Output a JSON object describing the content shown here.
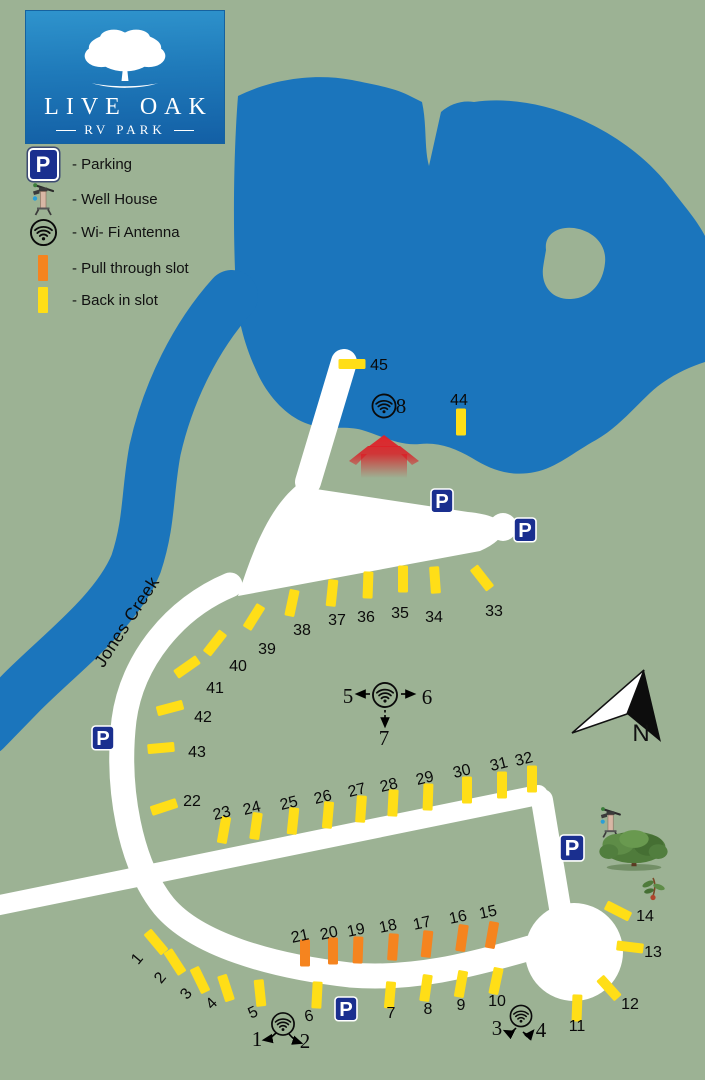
{
  "logo": {
    "title": "LIVE OAK",
    "subtitle": "RV PARK"
  },
  "legend": {
    "items": [
      {
        "icon": "parking-sign",
        "label": "- Parking"
      },
      {
        "icon": "well-house",
        "label": "- Well House"
      },
      {
        "icon": "wifi-antenna",
        "label": "- Wi- Fi Antenna"
      },
      {
        "icon": "pull-through-slot",
        "label": "- Pull through slot"
      },
      {
        "icon": "back-in-slot",
        "label": "- Back in slot"
      }
    ]
  },
  "map": {
    "creek_label": "Jones Creek",
    "north_label": "N",
    "parking_letter": "P",
    "colors": {
      "water": "#1B75BC",
      "ground": "#9CB294",
      "road": "#FFFFFF",
      "back_in": "#FFDE17",
      "pull_through": "#F5841F",
      "parking": "#1A2F8F",
      "building": "#E01F26"
    },
    "parking_signs": [
      {
        "x": 431,
        "y": 489,
        "s": 22
      },
      {
        "x": 514,
        "y": 518,
        "s": 22
      },
      {
        "x": 92,
        "y": 726,
        "s": 22
      },
      {
        "x": 560,
        "y": 835,
        "s": 24
      },
      {
        "x": 335,
        "y": 997,
        "s": 22
      }
    ],
    "slots": [
      {
        "n": 1,
        "cx": 156,
        "cy": 942,
        "rot": -40,
        "lx": 141,
        "ly": 962,
        "lrot": -50,
        "type": "back"
      },
      {
        "n": 2,
        "cx": 175,
        "cy": 962,
        "rot": -33,
        "lx": 164,
        "ly": 981,
        "lrot": -50,
        "type": "back"
      },
      {
        "n": 3,
        "cx": 200,
        "cy": 980,
        "rot": -26,
        "lx": 190,
        "ly": 997,
        "lrot": -50,
        "type": "back"
      },
      {
        "n": 4,
        "cx": 226,
        "cy": 988,
        "rot": -18,
        "lx": 215,
        "ly": 1007,
        "lrot": -45,
        "type": "back"
      },
      {
        "n": 5,
        "cx": 260,
        "cy": 993,
        "rot": -6,
        "lx": 255,
        "ly": 1017,
        "lrot": -25,
        "type": "back"
      },
      {
        "n": 6,
        "cx": 317,
        "cy": 995,
        "rot": 3,
        "lx": 310,
        "ly": 1021,
        "lrot": -12,
        "type": "back"
      },
      {
        "n": 7,
        "cx": 390,
        "cy": 995,
        "rot": 5,
        "lx": 391,
        "ly": 1018,
        "lrot": 0,
        "type": "back"
      },
      {
        "n": 8,
        "cx": 426,
        "cy": 988,
        "rot": 8,
        "lx": 428,
        "ly": 1014,
        "lrot": 0,
        "type": "back"
      },
      {
        "n": 9,
        "cx": 461,
        "cy": 984,
        "rot": 10,
        "lx": 461,
        "ly": 1010,
        "lrot": 0,
        "type": "back"
      },
      {
        "n": 10,
        "cx": 496,
        "cy": 981,
        "rot": 12,
        "lx": 497,
        "ly": 1006,
        "lrot": 0,
        "type": "back"
      },
      {
        "n": 11,
        "cx": 577,
        "cy": 1008,
        "rot": 2,
        "lx": 577,
        "ly": 1031,
        "lrot": 0,
        "type": "back"
      },
      {
        "n": 12,
        "cx": 609,
        "cy": 988,
        "rot": -42,
        "lx": 630,
        "ly": 1009,
        "lrot": 0,
        "type": "back"
      },
      {
        "n": 13,
        "cx": 630,
        "cy": 947,
        "rot": -83,
        "lx": 653,
        "ly": 957,
        "lrot": 0,
        "type": "back"
      },
      {
        "n": 14,
        "cx": 618,
        "cy": 911,
        "rot": -63,
        "lx": 645,
        "ly": 921,
        "lrot": 0,
        "type": "back"
      },
      {
        "n": 15,
        "cx": 492,
        "cy": 935,
        "rot": 10,
        "lx": 489,
        "ly": 917,
        "lrot": -12,
        "type": "pull"
      },
      {
        "n": 16,
        "cx": 462,
        "cy": 938,
        "rot": 8,
        "lx": 459,
        "ly": 922,
        "lrot": -12,
        "type": "pull"
      },
      {
        "n": 17,
        "cx": 427,
        "cy": 944,
        "rot": 6,
        "lx": 423,
        "ly": 928,
        "lrot": -12,
        "type": "pull"
      },
      {
        "n": 18,
        "cx": 393,
        "cy": 947,
        "rot": 4,
        "lx": 389,
        "ly": 931,
        "lrot": -12,
        "type": "pull"
      },
      {
        "n": 19,
        "cx": 358,
        "cy": 950,
        "rot": 2,
        "lx": 357,
        "ly": 935,
        "lrot": -12,
        "type": "pull"
      },
      {
        "n": 20,
        "cx": 333,
        "cy": 951,
        "rot": 0,
        "lx": 330,
        "ly": 938,
        "lrot": -12,
        "type": "pull"
      },
      {
        "n": 21,
        "cx": 305,
        "cy": 953,
        "rot": 0,
        "lx": 301,
        "ly": 941,
        "lrot": -12,
        "type": "pull"
      },
      {
        "n": 22,
        "cx": 164,
        "cy": 807,
        "rot": 72,
        "lx": 192,
        "ly": 806,
        "lrot": 0,
        "type": "back"
      },
      {
        "n": 23,
        "cx": 224,
        "cy": 830,
        "rot": 10,
        "lx": 223,
        "ly": 818,
        "lrot": -14,
        "type": "back"
      },
      {
        "n": 24,
        "cx": 256,
        "cy": 826,
        "rot": 8,
        "lx": 253,
        "ly": 813,
        "lrot": -14,
        "type": "back"
      },
      {
        "n": 25,
        "cx": 293,
        "cy": 821,
        "rot": 6,
        "lx": 290,
        "ly": 808,
        "lrot": -14,
        "type": "back"
      },
      {
        "n": 26,
        "cx": 328,
        "cy": 815,
        "rot": 5,
        "lx": 324,
        "ly": 802,
        "lrot": -14,
        "type": "back"
      },
      {
        "n": 27,
        "cx": 361,
        "cy": 809,
        "rot": 4,
        "lx": 358,
        "ly": 795,
        "lrot": -14,
        "type": "back"
      },
      {
        "n": 28,
        "cx": 393,
        "cy": 803,
        "rot": 3,
        "lx": 390,
        "ly": 790,
        "lrot": -14,
        "type": "back"
      },
      {
        "n": 29,
        "cx": 428,
        "cy": 797,
        "rot": 2,
        "lx": 426,
        "ly": 783,
        "lrot": -14,
        "type": "back"
      },
      {
        "n": 30,
        "cx": 467,
        "cy": 790,
        "rot": 0,
        "lx": 463,
        "ly": 776,
        "lrot": -14,
        "type": "back"
      },
      {
        "n": 31,
        "cx": 502,
        "cy": 785,
        "rot": 0,
        "lx": 500,
        "ly": 769,
        "lrot": -14,
        "type": "back"
      },
      {
        "n": 32,
        "cx": 532,
        "cy": 779,
        "rot": 0,
        "lx": 525,
        "ly": 764,
        "lrot": -14,
        "type": "back"
      },
      {
        "n": 33,
        "cx": 482,
        "cy": 578,
        "rot": -38,
        "lx": 494,
        "ly": 616,
        "lrot": 0,
        "type": "back"
      },
      {
        "n": 34,
        "cx": 435,
        "cy": 580,
        "rot": -4,
        "lx": 434,
        "ly": 622,
        "lrot": 0,
        "type": "back"
      },
      {
        "n": 35,
        "cx": 403,
        "cy": 579,
        "rot": 0,
        "lx": 400,
        "ly": 618,
        "lrot": 0,
        "type": "back"
      },
      {
        "n": 36,
        "cx": 368,
        "cy": 585,
        "rot": 2,
        "lx": 366,
        "ly": 622,
        "lrot": 0,
        "type": "back"
      },
      {
        "n": 37,
        "cx": 332,
        "cy": 593,
        "rot": 6,
        "lx": 337,
        "ly": 625,
        "lrot": 0,
        "type": "back"
      },
      {
        "n": 38,
        "cx": 292,
        "cy": 603,
        "rot": 12,
        "lx": 302,
        "ly": 635,
        "lrot": 0,
        "type": "back"
      },
      {
        "n": 39,
        "cx": 254,
        "cy": 617,
        "rot": 32,
        "lx": 267,
        "ly": 654,
        "lrot": 0,
        "type": "back"
      },
      {
        "n": 40,
        "cx": 215,
        "cy": 643,
        "rot": 38,
        "lx": 238,
        "ly": 671,
        "lrot": 0,
        "type": "back"
      },
      {
        "n": 41,
        "cx": 187,
        "cy": 667,
        "rot": 55,
        "lx": 215,
        "ly": 693,
        "lrot": 0,
        "type": "back"
      },
      {
        "n": 42,
        "cx": 170,
        "cy": 708,
        "rot": 75,
        "lx": 203,
        "ly": 722,
        "lrot": 0,
        "type": "back"
      },
      {
        "n": 43,
        "cx": 161,
        "cy": 748,
        "rot": 85,
        "lx": 197,
        "ly": 757,
        "lrot": 0,
        "type": "back"
      },
      {
        "n": 44,
        "cx": 461,
        "cy": 422,
        "rot": 0,
        "lx": 459,
        "ly": 405,
        "lrot": 0,
        "type": "back"
      },
      {
        "n": 45,
        "cx": 352,
        "cy": 364,
        "rot": 90,
        "lx": 379,
        "ly": 370,
        "lrot": 0,
        "type": "back"
      }
    ],
    "wifi_points": [
      {
        "id": "wifi-8",
        "cx": 384,
        "cy": 406,
        "r": 12,
        "labels": [
          {
            "t": "8",
            "x": 401,
            "y": 413
          }
        ],
        "arrows": []
      },
      {
        "id": "wifi-5-6-7",
        "cx": 385,
        "cy": 695,
        "r": 12.5,
        "labels": [
          {
            "t": "5",
            "x": 348,
            "y": 703
          },
          {
            "t": "6",
            "x": 427,
            "y": 704
          },
          {
            "t": "7",
            "x": 384,
            "y": 745
          }
        ],
        "arrows": [
          {
            "d": "M 370 694 L 357 694"
          },
          {
            "d": "M 401 694 L 414 694"
          },
          {
            "d": "M 385 710 L 385 726",
            "dash": true
          }
        ]
      },
      {
        "id": "wifi-1-2",
        "cx": 283,
        "cy": 1024,
        "r": 11.5,
        "labels": [
          {
            "t": "1",
            "x": 257,
            "y": 1046
          },
          {
            "t": "2",
            "x": 305,
            "y": 1048
          }
        ],
        "arrows": [
          {
            "d": "M 276 1033 Q 270 1039 264 1040"
          },
          {
            "d": "M 289 1034 Q 295 1041 301 1043"
          }
        ]
      },
      {
        "id": "wifi-3-4",
        "cx": 521,
        "cy": 1016,
        "r": 11,
        "labels": [
          {
            "t": "3",
            "x": 497,
            "y": 1035
          },
          {
            "t": "4",
            "x": 541,
            "y": 1037
          }
        ],
        "arrows": [
          {
            "d": "M 516 1028 Q 511 1034 505 1031"
          },
          {
            "d": "M 523 1032 Q 528 1037 533 1031"
          }
        ]
      }
    ]
  }
}
